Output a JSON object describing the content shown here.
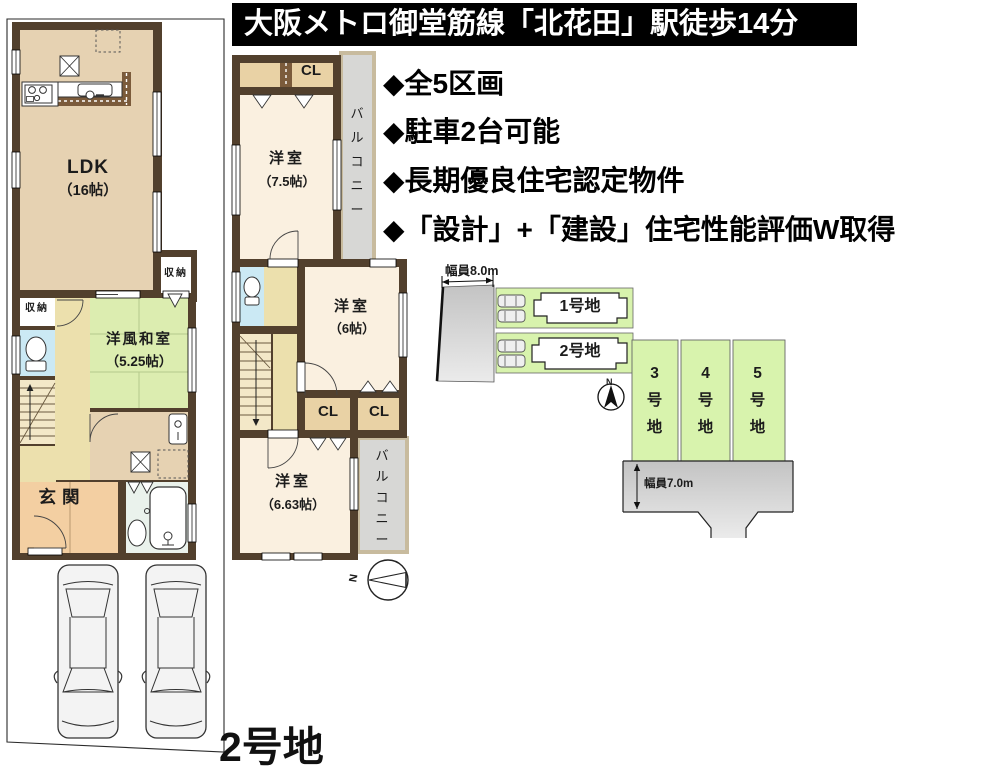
{
  "banner": {
    "text": "大阪メトロ御堂筋線「北花田」駅徒歩14分"
  },
  "features": [
    "◆全5区画",
    "◆駐車2台可能",
    "◆長期優良住宅認定物件",
    "◆「設計」+「建設」住宅性能評価W取得"
  ],
  "floor1": {
    "ldk": {
      "name": "LDK",
      "size": "（16帖）"
    },
    "storage_right": "収納",
    "storage_left": "収納",
    "washitsu": {
      "name": "洋風和室",
      "size": "（5.25帖）"
    },
    "entrance": "玄関"
  },
  "floor2": {
    "closet_top": "CL",
    "room_a": {
      "name": "洋室",
      "size": "（7.5帖）"
    },
    "balcony_top": "バルコニー",
    "room_b": {
      "name": "洋室",
      "size": "（6帖）"
    },
    "closet_1": "CL",
    "closet_2": "CL",
    "room_c": {
      "name": "洋室",
      "size": "（6.63帖）"
    },
    "balcony_bottom": "バルコニー",
    "compass_n": "N"
  },
  "siteplan": {
    "road_left_width": "幅員8.0m",
    "road_bottom_width": "幅員7.0m",
    "lot1": "1号地",
    "lot2": "2号地",
    "lot3": "3号地",
    "lot4": "4号地",
    "lot5": "5号地",
    "compass_n": "N"
  },
  "caption": "2号地",
  "palette": {
    "wall": "#52402d",
    "ldk_floor": "#e6d2b2",
    "tatami": "#dcedb0",
    "hall": "#ece0ad",
    "stairs": "#f3e8c8",
    "entrance": "#f3cfa2",
    "toilet": "#cbe9f4",
    "bath": "#eaf2ec",
    "room_2f": "#faf0e0",
    "closet": "#e9d2a5",
    "balcony": "#d7d7d5",
    "lot_green": "#d8f3ad",
    "road_gray": "#d2d2d2",
    "banner_bg": "#000000",
    "banner_fg": "#ffffff"
  }
}
